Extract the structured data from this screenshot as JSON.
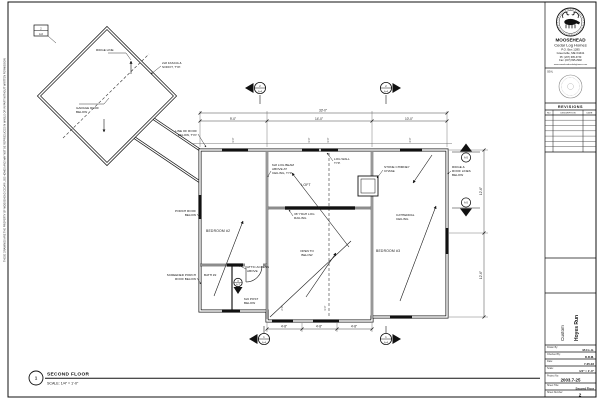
{
  "sheet": {
    "copyright": "THESE DRAWINGS ARE THE PROPERTY OF MOOSEHEAD CEDAR LOG HOMES AND MAY NOT BE REPRODUCED IN WHOLE OR IN PART WITHOUT WRITTEN PERMISSION",
    "drawing_title": {
      "number": "1",
      "name": "SECOND FLOOR",
      "scale": "SCALE: 1/4\" = 1'-0\""
    }
  },
  "title_block": {
    "company": {
      "name": "MOOSEHEAD",
      "tagline": "Cedar Log Homes",
      "address1": "P.O. Box 1285",
      "address2": "Greenville, ME 04441",
      "phone": "Ph: (207) 695-3730",
      "fax": "Fax: (207) 695-2992",
      "web": "www.mooseheadcedarloghomes.com"
    },
    "seal_label": "SEAL",
    "revisions": {
      "title": "REVISIONS",
      "col_no": "NO.",
      "col_desc": "DESCRIPTION",
      "col_date": "DATE"
    },
    "project": {
      "type": "Custom",
      "name": "Hoyes Run"
    },
    "fields": [
      {
        "label": "Drawn By:",
        "value": "M.C.L.H."
      },
      {
        "label": "Checked By:",
        "value": "D.R.M."
      },
      {
        "label": "Date:",
        "value": "7-25-03"
      },
      {
        "label": "Scale:",
        "value": "1/4\" = 1'-0\""
      },
      {
        "label": "Project No:",
        "value": "2003.7-25"
      },
      {
        "label": "Sheet Title:",
        "value": "Second Floor"
      },
      {
        "label": "Sheet Number:",
        "value": "2"
      }
    ]
  },
  "plan": {
    "labels": {
      "ridge": "RIDGE LINE",
      "garage_1": "GARAGE ROOF",
      "garage_2": "BELOW",
      "eave_1": "2x8 FASCIA &",
      "eave_2": "SOFFIT, TYP.",
      "edge_1": "LINE OF ROOF",
      "edge_2": "BELOW, TYP.",
      "porch_1": "PORCH ROOF",
      "porch_2": "BELOW",
      "deck_1": "SCREENED PORCH",
      "deck_2": "ROOF BELOW",
      "bath": "BATH #2",
      "attic_1": "ATTIC ACCESS",
      "attic_2": "ABOVE",
      "post_1": "6x6 POST",
      "post_2": "BELOW",
      "room_left": "BEDROOM #2",
      "room_right": "BEDROOM #3",
      "loft": "LOFT",
      "open_1": "OPEN TO",
      "open_2": "BELOW",
      "beam_1": "6x8 LOG BEAM",
      "beam_2": "ABOVE AT",
      "beam_3": "CEILING, TYP.",
      "rail_1": "36\" HIGH LOG",
      "rail_2": "RAILING",
      "logwall_1": "LOG WALL",
      "logwall_2": "TYP.",
      "chase_1": "STONE CHIMNEY",
      "chase_2": "CHASE",
      "cath_1": "CATHEDRAL",
      "cath_2": "CEILING",
      "rr_1": "RIDGE &",
      "rr_2": "ROOF LINES",
      "rr_3": "BELOW"
    },
    "dims": {
      "top_overall": "33'-0\"",
      "top_left": "9'-0\"",
      "top_mid": "14'-0\"",
      "top_right": "10'-0\"",
      "bot_1": "4'-8\"",
      "bot_2": "4'-8\"",
      "bot_3": "4'-8\"",
      "right_1": "12'-6\"",
      "right_2": "12'-6\"",
      "win_1": "3'-0\"",
      "win_2": "3'-0\"",
      "win_3": "3'-0\"",
      "win_4": "4'-0\"",
      "botwin_1": "2'-8\"",
      "botwin_2": "3'-0\""
    },
    "markers": {
      "sec_top_left": {
        "num": "2",
        "sheet": "A-4"
      },
      "sec_top_right": {
        "num": "2",
        "sheet": "A-4"
      },
      "sec_bot_left": {
        "num": "1",
        "sheet": "A-4"
      },
      "sec_bot_right": {
        "num": "1",
        "sheet": "A-4"
      },
      "elev_upper": {
        "sheet": "A-5"
      },
      "elev_lower": {
        "sheet": "A-5"
      },
      "detail": {
        "num": "3",
        "sheet": "A-7"
      },
      "keynote": {
        "num": "2",
        "sheet": "A-6"
      }
    }
  }
}
